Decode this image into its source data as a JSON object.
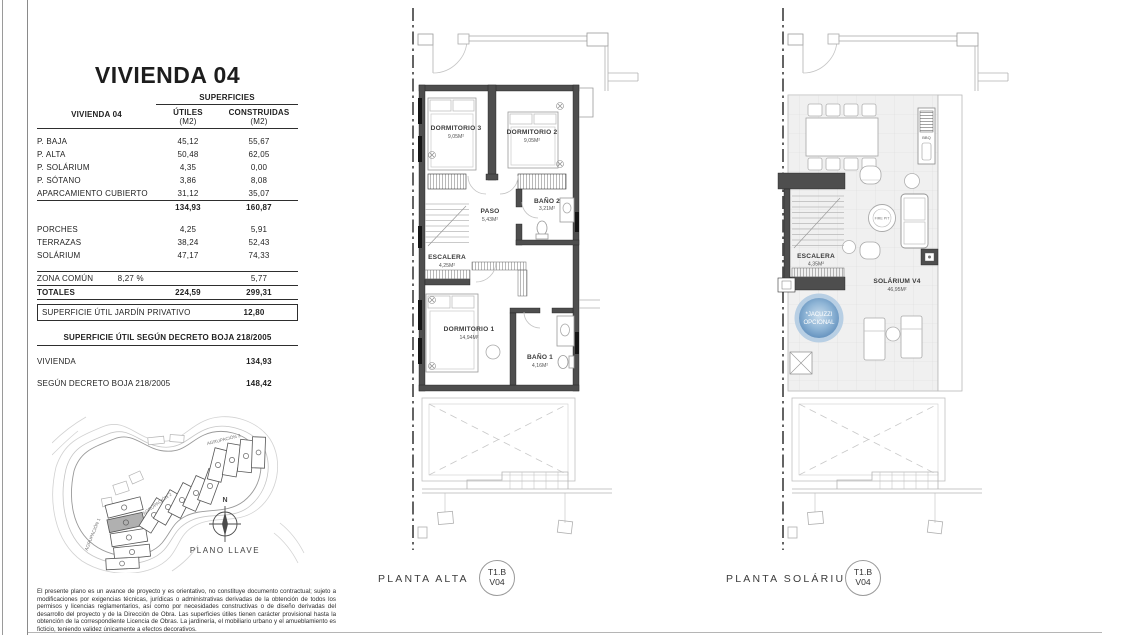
{
  "info_panel": {
    "title": "VIVIENDA 04",
    "table": {
      "row_header": "VIVIENDA 04",
      "group_header": "SUPERFICIES",
      "col_utiles": "ÚTILES",
      "col_utiles_unit": "(M2)",
      "col_construidas": "CONSTRUIDAS",
      "col_construidas_unit": "(M2)",
      "rows": [
        {
          "label": "P. BAJA",
          "utiles": "45,12",
          "construidas": "55,67"
        },
        {
          "label": "P. ALTA",
          "utiles": "50,48",
          "construidas": "62,05"
        },
        {
          "label": "P. SOLÁRIUM",
          "utiles": "4,35",
          "construidas": "0,00"
        },
        {
          "label": "P. SÓTANO",
          "utiles": "3,86",
          "construidas": "8,08"
        },
        {
          "label": "APARCAMIENTO CUBIERTO",
          "utiles": "31,12",
          "construidas": "35,07"
        }
      ],
      "subtotal": {
        "utiles": "134,93",
        "construidas": "160,87"
      },
      "rows_outdoor": [
        {
          "label": "PORCHES",
          "utiles": "4,25",
          "construidas": "5,91"
        },
        {
          "label": "TERRAZAS",
          "utiles": "38,24",
          "construidas": "52,43"
        },
        {
          "label": "SOLÁRIUM",
          "utiles": "47,17",
          "construidas": "74,33"
        }
      ],
      "zona_comun": {
        "label": "ZONA COMÚN",
        "pct": "8,27 %",
        "construidas": "5,77"
      },
      "totales": {
        "label": "TOTALES",
        "utiles": "224,59",
        "construidas": "299,31"
      },
      "jardin": {
        "label": "SUPERFICIE ÚTIL JARDÍN PRIVATIVO",
        "value": "12,80"
      },
      "decreto_header": "SUPERFICIE ÚTIL SEGÚN DECRETO BOJA 218/2005",
      "decreto_rows": [
        {
          "label": "VIVIENDA",
          "value": "134,93"
        },
        {
          "label": "SEGÚN DECRETO BOJA 218/2005",
          "value": "148,42"
        }
      ]
    }
  },
  "site_plan": {
    "agrupacion_1": "AGRUPACIÓN 1",
    "agrupacion_2": "AGRUPACIÓN 2",
    "agrupacion_3": "AGRUPACIÓN 3",
    "compass_north": "N",
    "caption": "PLANO LLAVE"
  },
  "planta_alta": {
    "caption": "PLANTA ALTA",
    "badge": {
      "line1": "T1.B",
      "line2": "V04"
    },
    "rooms": {
      "dormitorio3": {
        "name": "DORMITORIO 3",
        "area": "9,05M²"
      },
      "dormitorio2": {
        "name": "DORMITORIO 2",
        "area": "9,05M²"
      },
      "paso": {
        "name": "PASO",
        "area": "5,43M²"
      },
      "bano2": {
        "name": "BAÑO 2",
        "area": "3,21M²"
      },
      "escalera": {
        "name": "ESCALERA",
        "area": "4,25M²"
      },
      "dormitorio1": {
        "name": "DORMITORIO 1",
        "area": "14,94M²"
      },
      "bano1": {
        "name": "BAÑO 1",
        "area": "4,16M²"
      }
    }
  },
  "planta_solarium": {
    "caption": "PLANTA SOLÁRIUM",
    "badge": {
      "line1": "T1.B",
      "line2": "V04"
    },
    "rooms": {
      "escalera": {
        "name": "ESCALERA",
        "area": "4,35M²"
      },
      "solarium": {
        "name": "SOLÁRIUM V4",
        "area": "46,95M²"
      }
    },
    "jacuzzi": {
      "line1": "*JACUZZI",
      "line2": "OPCIONAL"
    },
    "firepit": "FIRE PIT",
    "bbq": "BBQ"
  },
  "legal": {
    "text": "El presente plano es un avance de proyecto y es orientativo, no constituye documento contractual; sujeto a modificaciones por exigencias técnicas, jurídicas o administrativas derivadas de la obtención de todos los permisos y licencias reglamentarios, así como por necesidades constructivas o de diseño derivadas del desarrollo del proyecto y de la Dirección de Obra. Las superficies útiles tienen carácter provisional hasta la obtención de la correspondiente Licencia de Obras. La jardinería, el mobiliario urbano y el amueblamiento es ficticio, teniendo validez únicamente a efectos decorativos."
  },
  "colors": {
    "wall_gray": "#4e4e4e",
    "jacuzzi_blue": "#74a3cd",
    "highlight_unit_gray": "#b0b0b0"
  }
}
